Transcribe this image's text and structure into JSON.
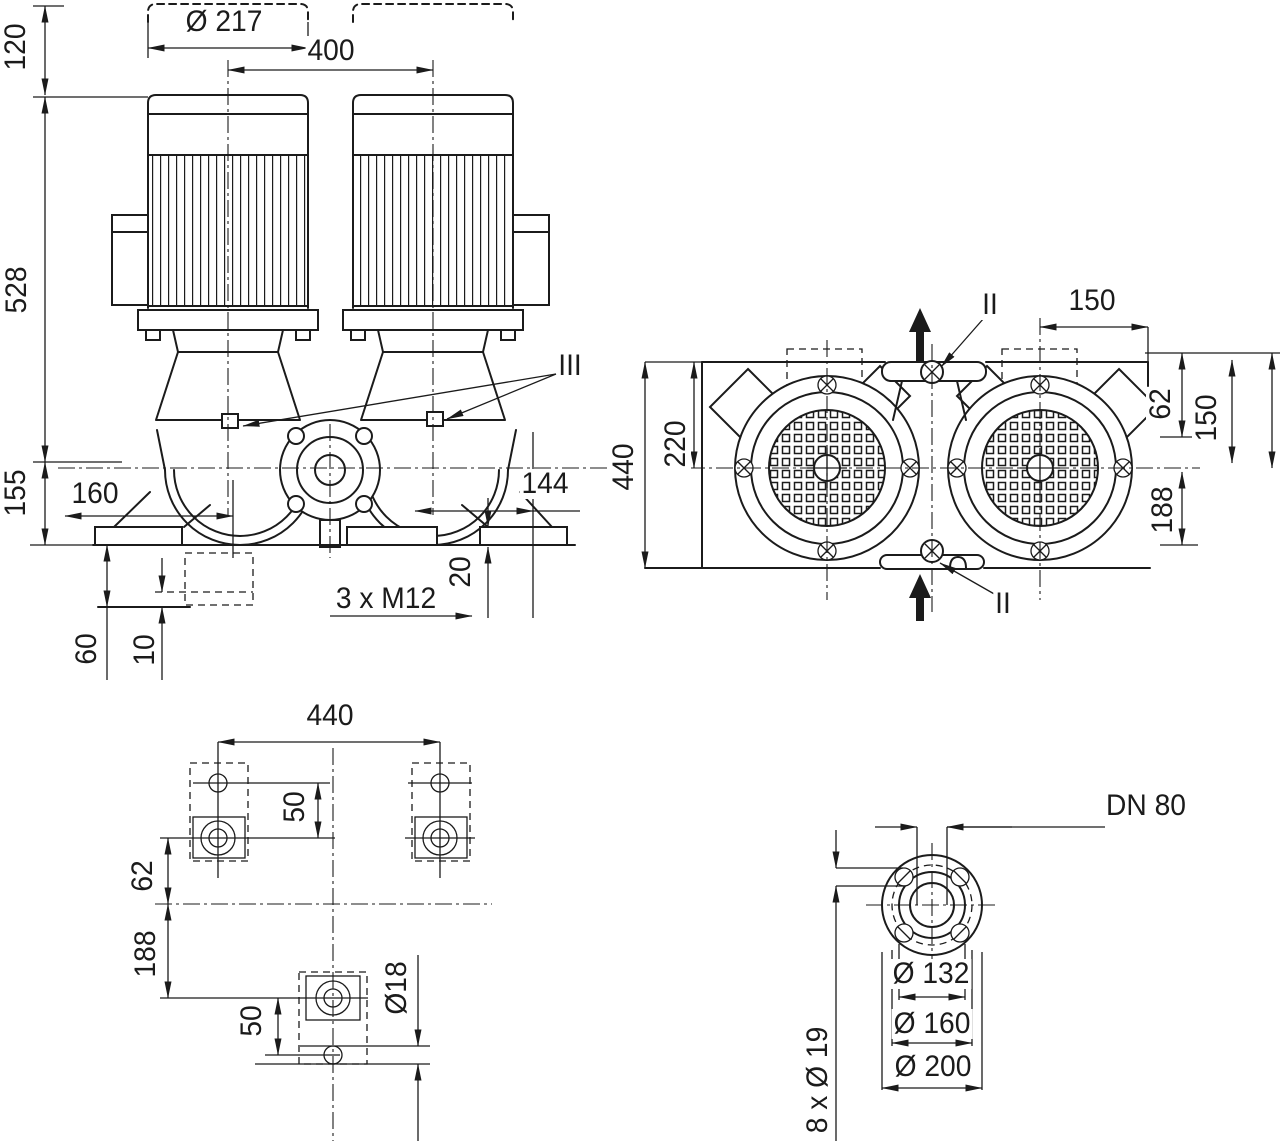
{
  "drawing": {
    "subject": "Twin inline pump dimensional drawing",
    "ink_color": "#1b1b1b",
    "background_color": "#ffffff"
  },
  "views": {
    "front": {
      "name": "front elevation",
      "dims": {
        "motor_top_ext": "120",
        "motor_dia": "Ø 217",
        "motor_spacing": "400",
        "axis_to_top": "528",
        "axis_to_base": "155",
        "port_left": "160",
        "port_right": "144",
        "pad_height": "20",
        "anchor_bolts": "3 x M12",
        "foundation_depth": "60",
        "grout_layer": "10",
        "detail_marker": "III"
      }
    },
    "plan": {
      "name": "top view",
      "dims": {
        "overall_width": "440",
        "half_width": "220",
        "port_offset_top": "150",
        "edge_to_axis": "62",
        "axis_span": "150",
        "axis_to_bolt": "188",
        "vent_marker_top": "II",
        "vent_marker_bottom": "II"
      }
    },
    "foundation": {
      "name": "foundation plan",
      "dims": {
        "bolt_spacing": "440",
        "hole_pitch_top": "50",
        "axis_offset": "62",
        "axis_to_bolt": "188",
        "hole_pitch_bottom": "50",
        "hole_dia": "Ø18"
      }
    },
    "flange": {
      "name": "flange detail",
      "dims": {
        "nominal": "DN 80",
        "raised_face": "Ø 132",
        "bolt_circle": "Ø 160",
        "outer_dia": "Ø 200",
        "bolt_holes": "8 x Ø 19"
      }
    }
  }
}
